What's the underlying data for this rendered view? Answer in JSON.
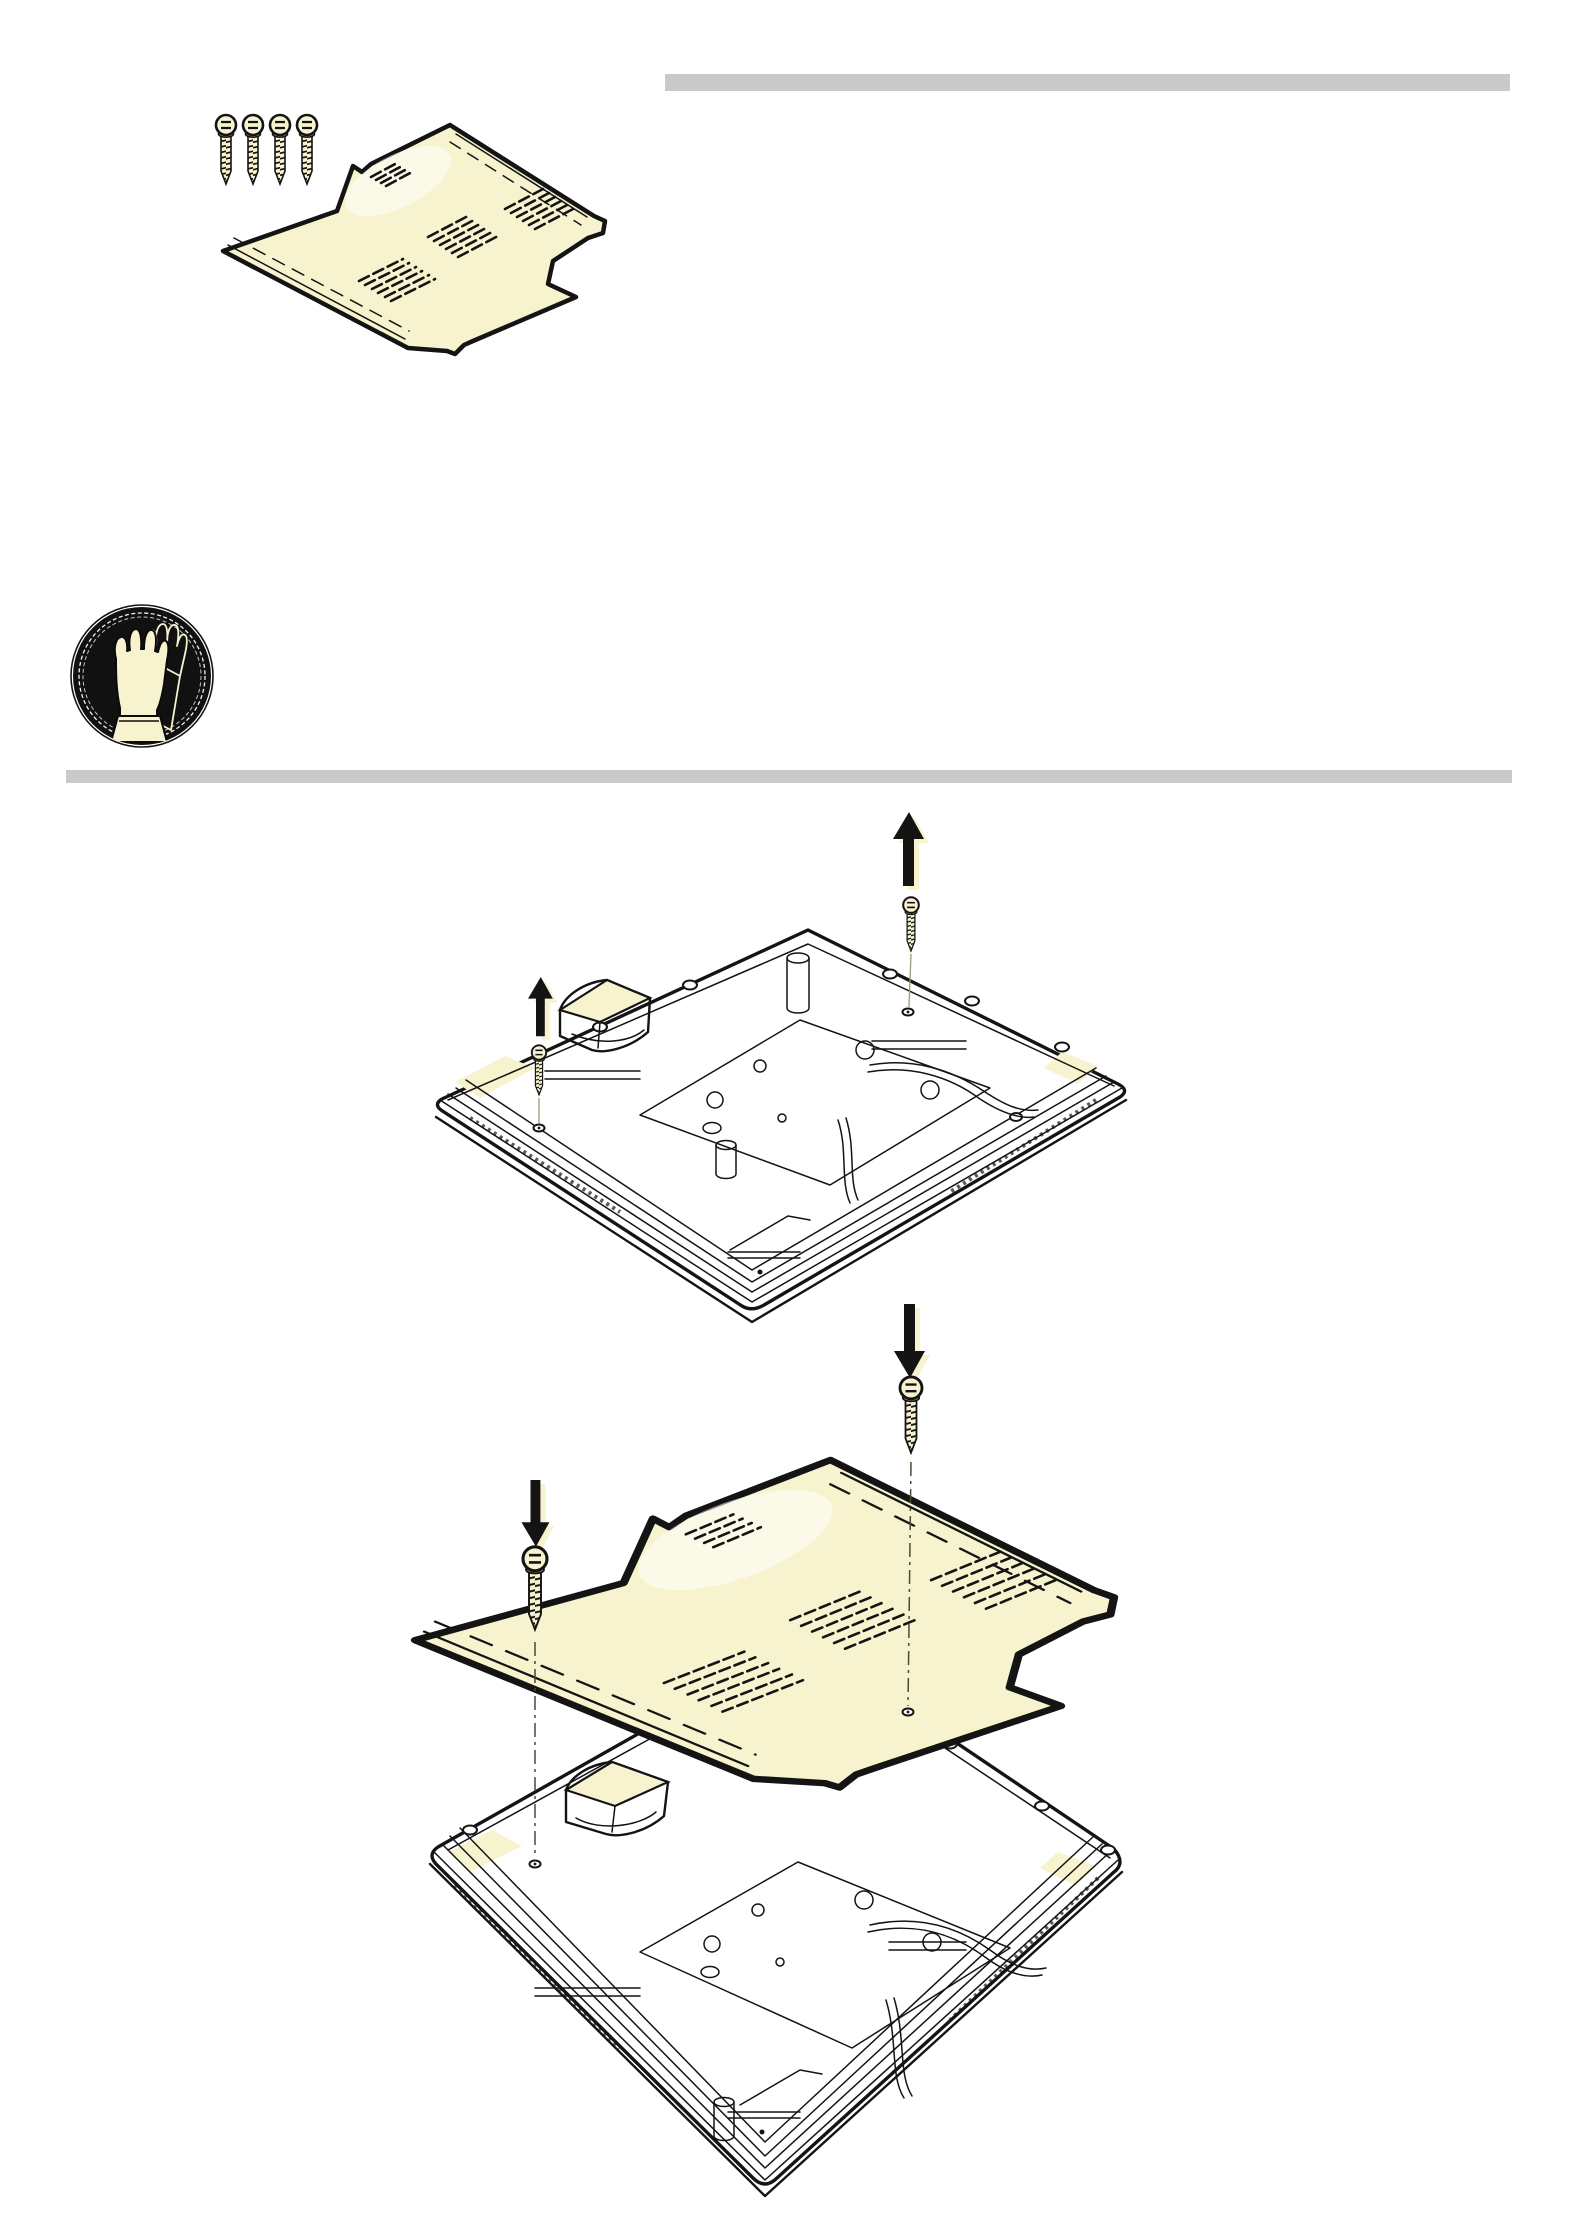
{
  "page": {
    "background": "#ffffff"
  },
  "colors": {
    "highlight_cream": "#f7f3cf",
    "rule_gray": "#c9c9c9",
    "line_black": "#141414",
    "paper_white": "#ffffff"
  },
  "rules": {
    "top_right_rule": {
      "color": "#c9c9c9"
    },
    "section_divider_rule": {
      "color": "#c9c9c9"
    }
  },
  "figures": {
    "parts": {
      "name": "supplied-parts-figure",
      "aria_label": "Four fastening screws and cream insulation mat",
      "screw_count": 4
    },
    "safety": {
      "name": "wear-protective-gloves-icon",
      "aria_label": "Mandatory sign: wear protective gloves"
    },
    "step_remove": {
      "name": "remove-screws-step-figure",
      "aria_label": "Cooktop underside: remove the two screws (arrows point up)",
      "arrow_direction": "up",
      "screw_count": 2
    },
    "step_install": {
      "name": "install-mat-step-figure",
      "aria_label": "Lower the insulation mat onto the cooktop underside and secure with the two screws (arrows point down)",
      "arrow_direction": "down",
      "screw_count": 2
    }
  }
}
